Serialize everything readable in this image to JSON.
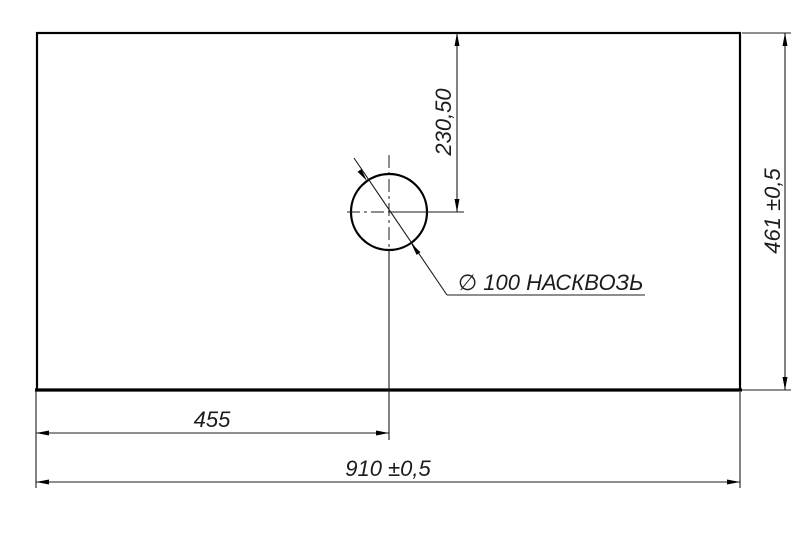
{
  "drawing": {
    "type": "technical-dimension-drawing",
    "background_color": "#ffffff",
    "line_color": "#000000",
    "labels": {
      "panel_width": "910 ±0,5",
      "panel_height": "461 ±0,5",
      "hole_center_from_left": "455",
      "hole_center_from_top": "230,50",
      "hole_callout": "∅ 100 НАСКВОЗЬ"
    }
  }
}
